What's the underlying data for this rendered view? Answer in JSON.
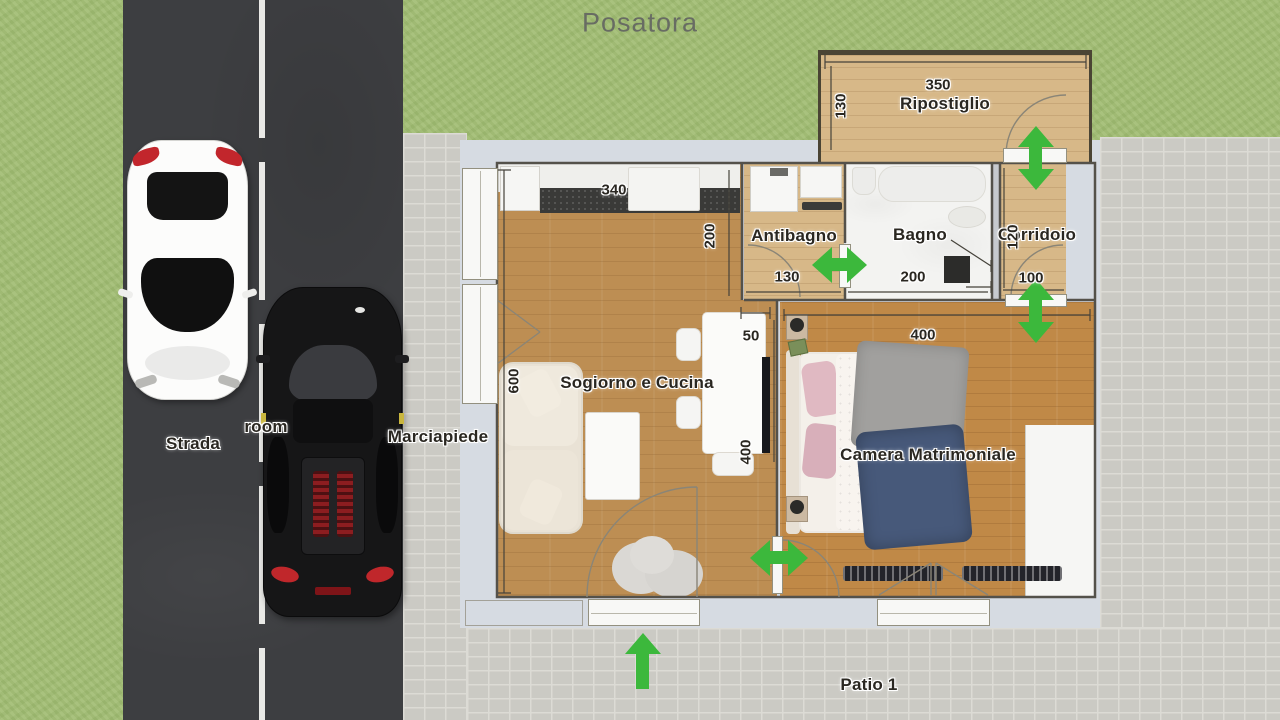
{
  "title": "Posatora",
  "outdoor": {
    "strada": "Strada",
    "room": "room",
    "marciapiede": "Marciapiede",
    "patio": "Patio 1"
  },
  "rooms": {
    "soggiorno": "Sogiorno e Cucina",
    "antibagno": "Antibagno",
    "bagno": "Bagno",
    "corridoio": "Corridoio",
    "camera": "Camera Matrimoniale",
    "ripostiglio": "Ripostiglio"
  },
  "dimensions": {
    "soggiorno_top": "340",
    "soggiorno_right": "200",
    "soggiorno_left": "600",
    "table_width": "50",
    "table_length": "400",
    "antibagno_width": "130",
    "bagno_width": "200",
    "corridoio_height": "120",
    "corridoio_width": "100",
    "camera_width": "400",
    "ripostiglio_width": "350",
    "ripostiglio_height": "130"
  },
  "colors": {
    "arrow_green": "#3cb83c",
    "grass": "#a2bd74",
    "road": "#3d3e41",
    "paver": "#cbcac4",
    "slab": "#d6dbe2",
    "wood_living": "#bd8e53",
    "wood_bedroom": "#c08947",
    "wood_light": "#d7b888",
    "counter_dark": "#3a3a38",
    "road_line": "#e9e9e6"
  },
  "icons": {
    "direction_arrows": "green direction arrows marking door passages",
    "cars": "top view white car and black sports car on the street"
  }
}
